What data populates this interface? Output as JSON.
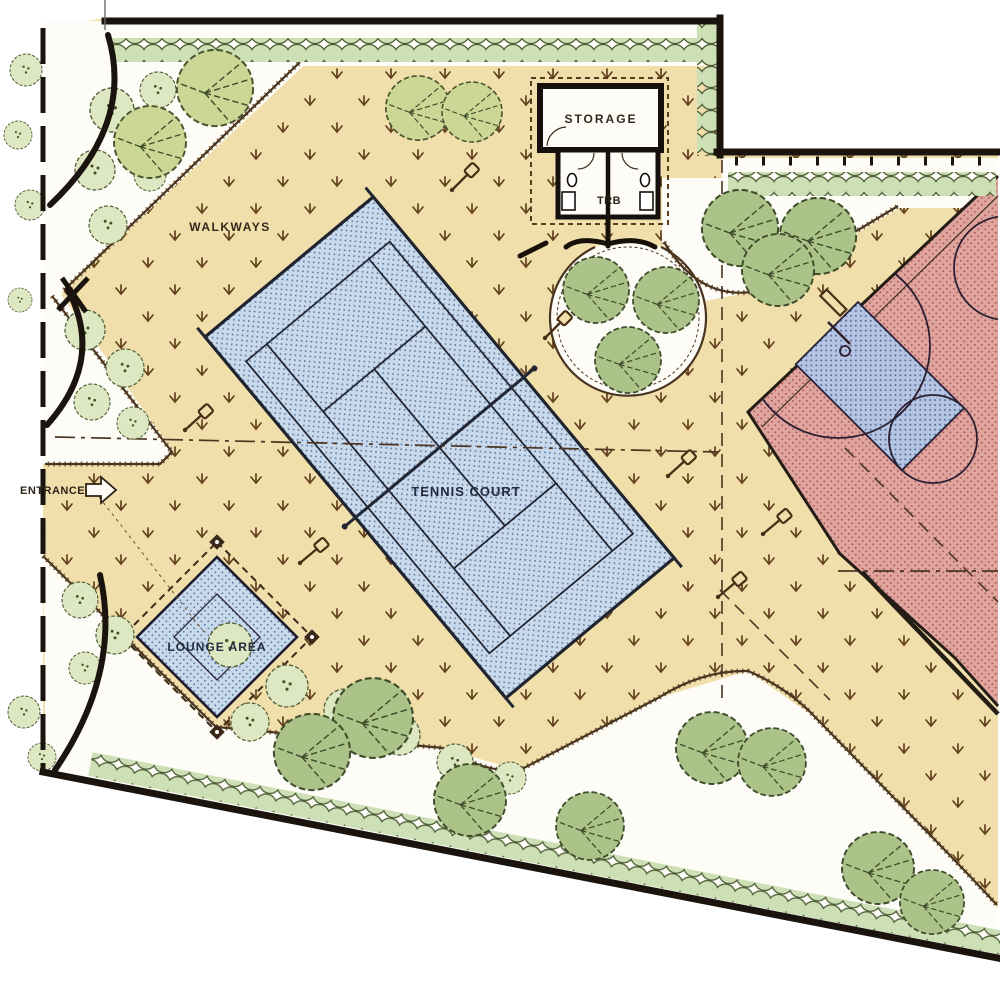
{
  "plan": {
    "labels": {
      "walkways": "WALKWAYS",
      "tennis_court": "TENNIS COURT",
      "lounge_area": "LOUNGE AREA",
      "storage": "STORAGE",
      "trb": "TRB",
      "entrance": "ENTRANCE"
    },
    "colors": {
      "paper": "#fdfcf6",
      "walkway_tan": "#f1dfab",
      "grass_mark_brown": "#63411f",
      "court_blue": "#c9d9ec",
      "court_blue_dot": "#58749f",
      "key_blue": "#b4c4e2",
      "basketball_red": "#e0a49f",
      "basketball_red_dot": "#a85a54",
      "tree_green": "#abc389",
      "tree_light_green": "#ccd795",
      "hedge_green": "#cde0b5",
      "shrub_green": "#dde7c2",
      "line_dark": "#1b140e",
      "line_brown": "#48341f"
    },
    "features": [
      "walkways",
      "tennis court",
      "basketball court",
      "lounge area",
      "storage building with restrooms",
      "circular planting bed",
      "perimeter hedge",
      "trees",
      "shrub beds",
      "benches",
      "entrance"
    ]
  }
}
